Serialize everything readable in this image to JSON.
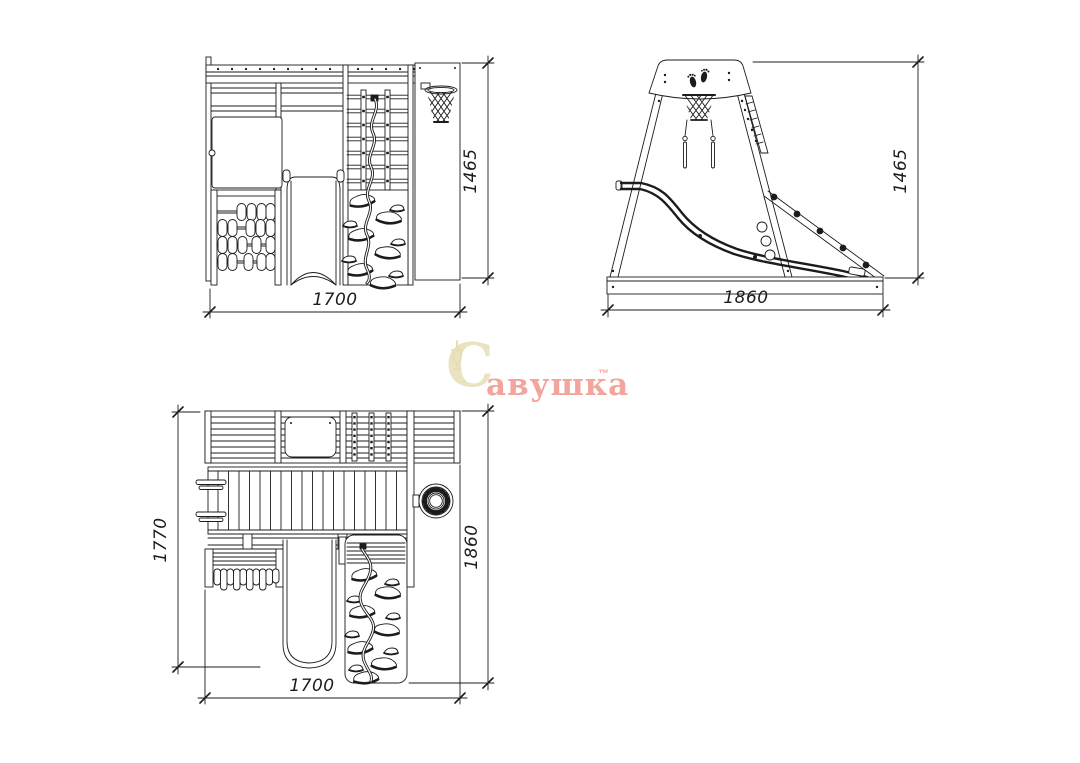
{
  "page": {
    "background": "#ffffff",
    "line_color": "#1c1c1c"
  },
  "drawing": {
    "dimensions": {
      "front_width": "1700",
      "front_height": "1465",
      "side_width": "1860",
      "side_height": "1465",
      "plan_width": "1700",
      "plan_depth_left": "1770",
      "plan_depth_right": "1860"
    }
  },
  "watermark": {
    "initial": "С",
    "rest": "авушка",
    "trademark": "™",
    "initial_color": "#eae3c2",
    "text_color": "#f2a59c"
  }
}
